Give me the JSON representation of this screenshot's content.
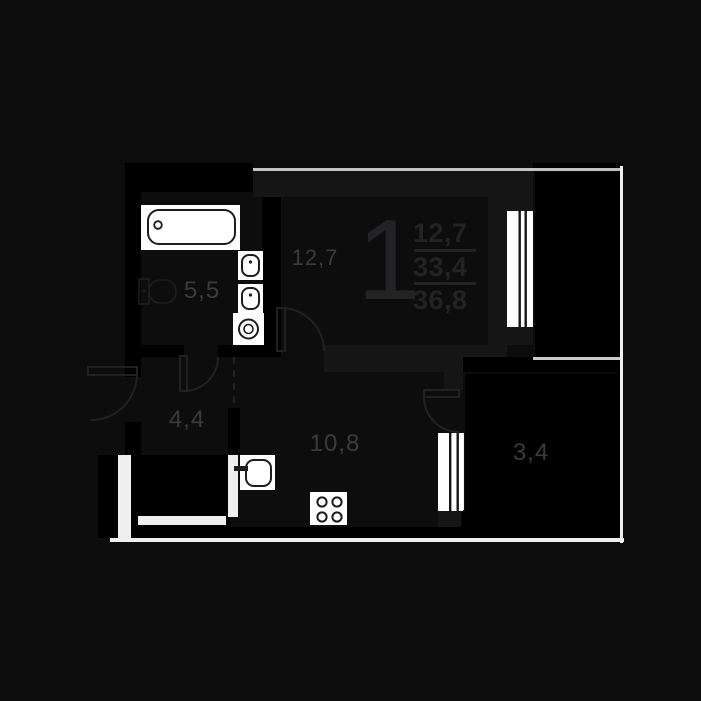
{
  "plan_type": "apartment-floor-plan",
  "unit_stats": {
    "rooms_count": "1",
    "living_area": "12,7",
    "area_without_balcony": "33,4",
    "total_area": "36,8"
  },
  "room_labels": {
    "living": "12,7",
    "bathroom": "5,5",
    "hallway": "4,4",
    "kitchen": "10,8",
    "balcony": "3,4"
  },
  "colors": {
    "background": "#0d0d0d",
    "walls": "#000000",
    "walls_soft": "#151515",
    "fixture_fill": "#ffffff",
    "fixture_stroke": "#1d1d1d",
    "boundary_line": "#efefef",
    "room_label": "#3b3b3d",
    "unit_numbers": "#232325"
  },
  "fixtures": [
    "bathtub-icon",
    "toilet-icon",
    "sink-icon",
    "sink-icon",
    "washing-machine-icon",
    "kitchen-sink-icon",
    "stove-icon",
    "window-icon",
    "window-icon",
    "door-arc",
    "door-arc",
    "door-arc",
    "door-arc",
    "dashed-opening"
  ]
}
